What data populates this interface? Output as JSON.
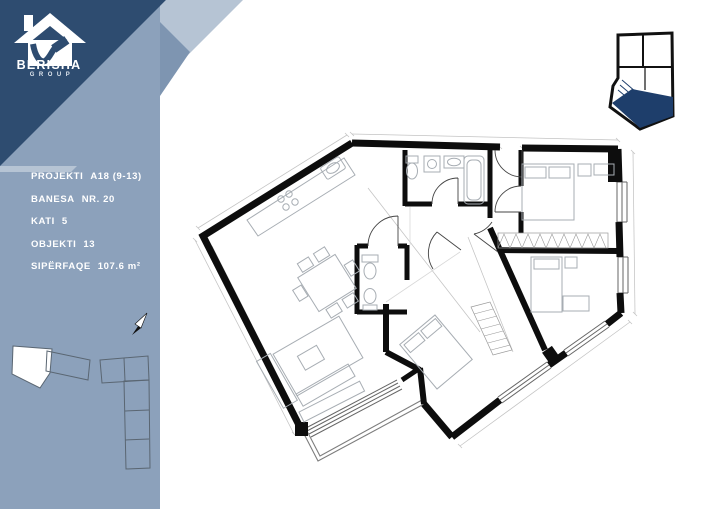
{
  "brand": {
    "name": "BERISHA",
    "group": "GROUP"
  },
  "project_info": [
    {
      "label": "PROJEKTI",
      "value": "A18 (9-13)"
    },
    {
      "label": "BANESA",
      "value": "NR. 20"
    },
    {
      "label": "KATI",
      "value": "5"
    },
    {
      "label": "OBJEKTI",
      "value": "13"
    },
    {
      "label": "SIPËRFAQE",
      "value": "107.6 m²"
    }
  ],
  "colors": {
    "navy": "#2E4C70",
    "pale_band": "#B6C4D4",
    "sidebar": "#8CA1BB",
    "accent_band": "#7E95B1",
    "keyplan_highlight": "#1E3E6B",
    "walls": "#0D0D0D"
  }
}
